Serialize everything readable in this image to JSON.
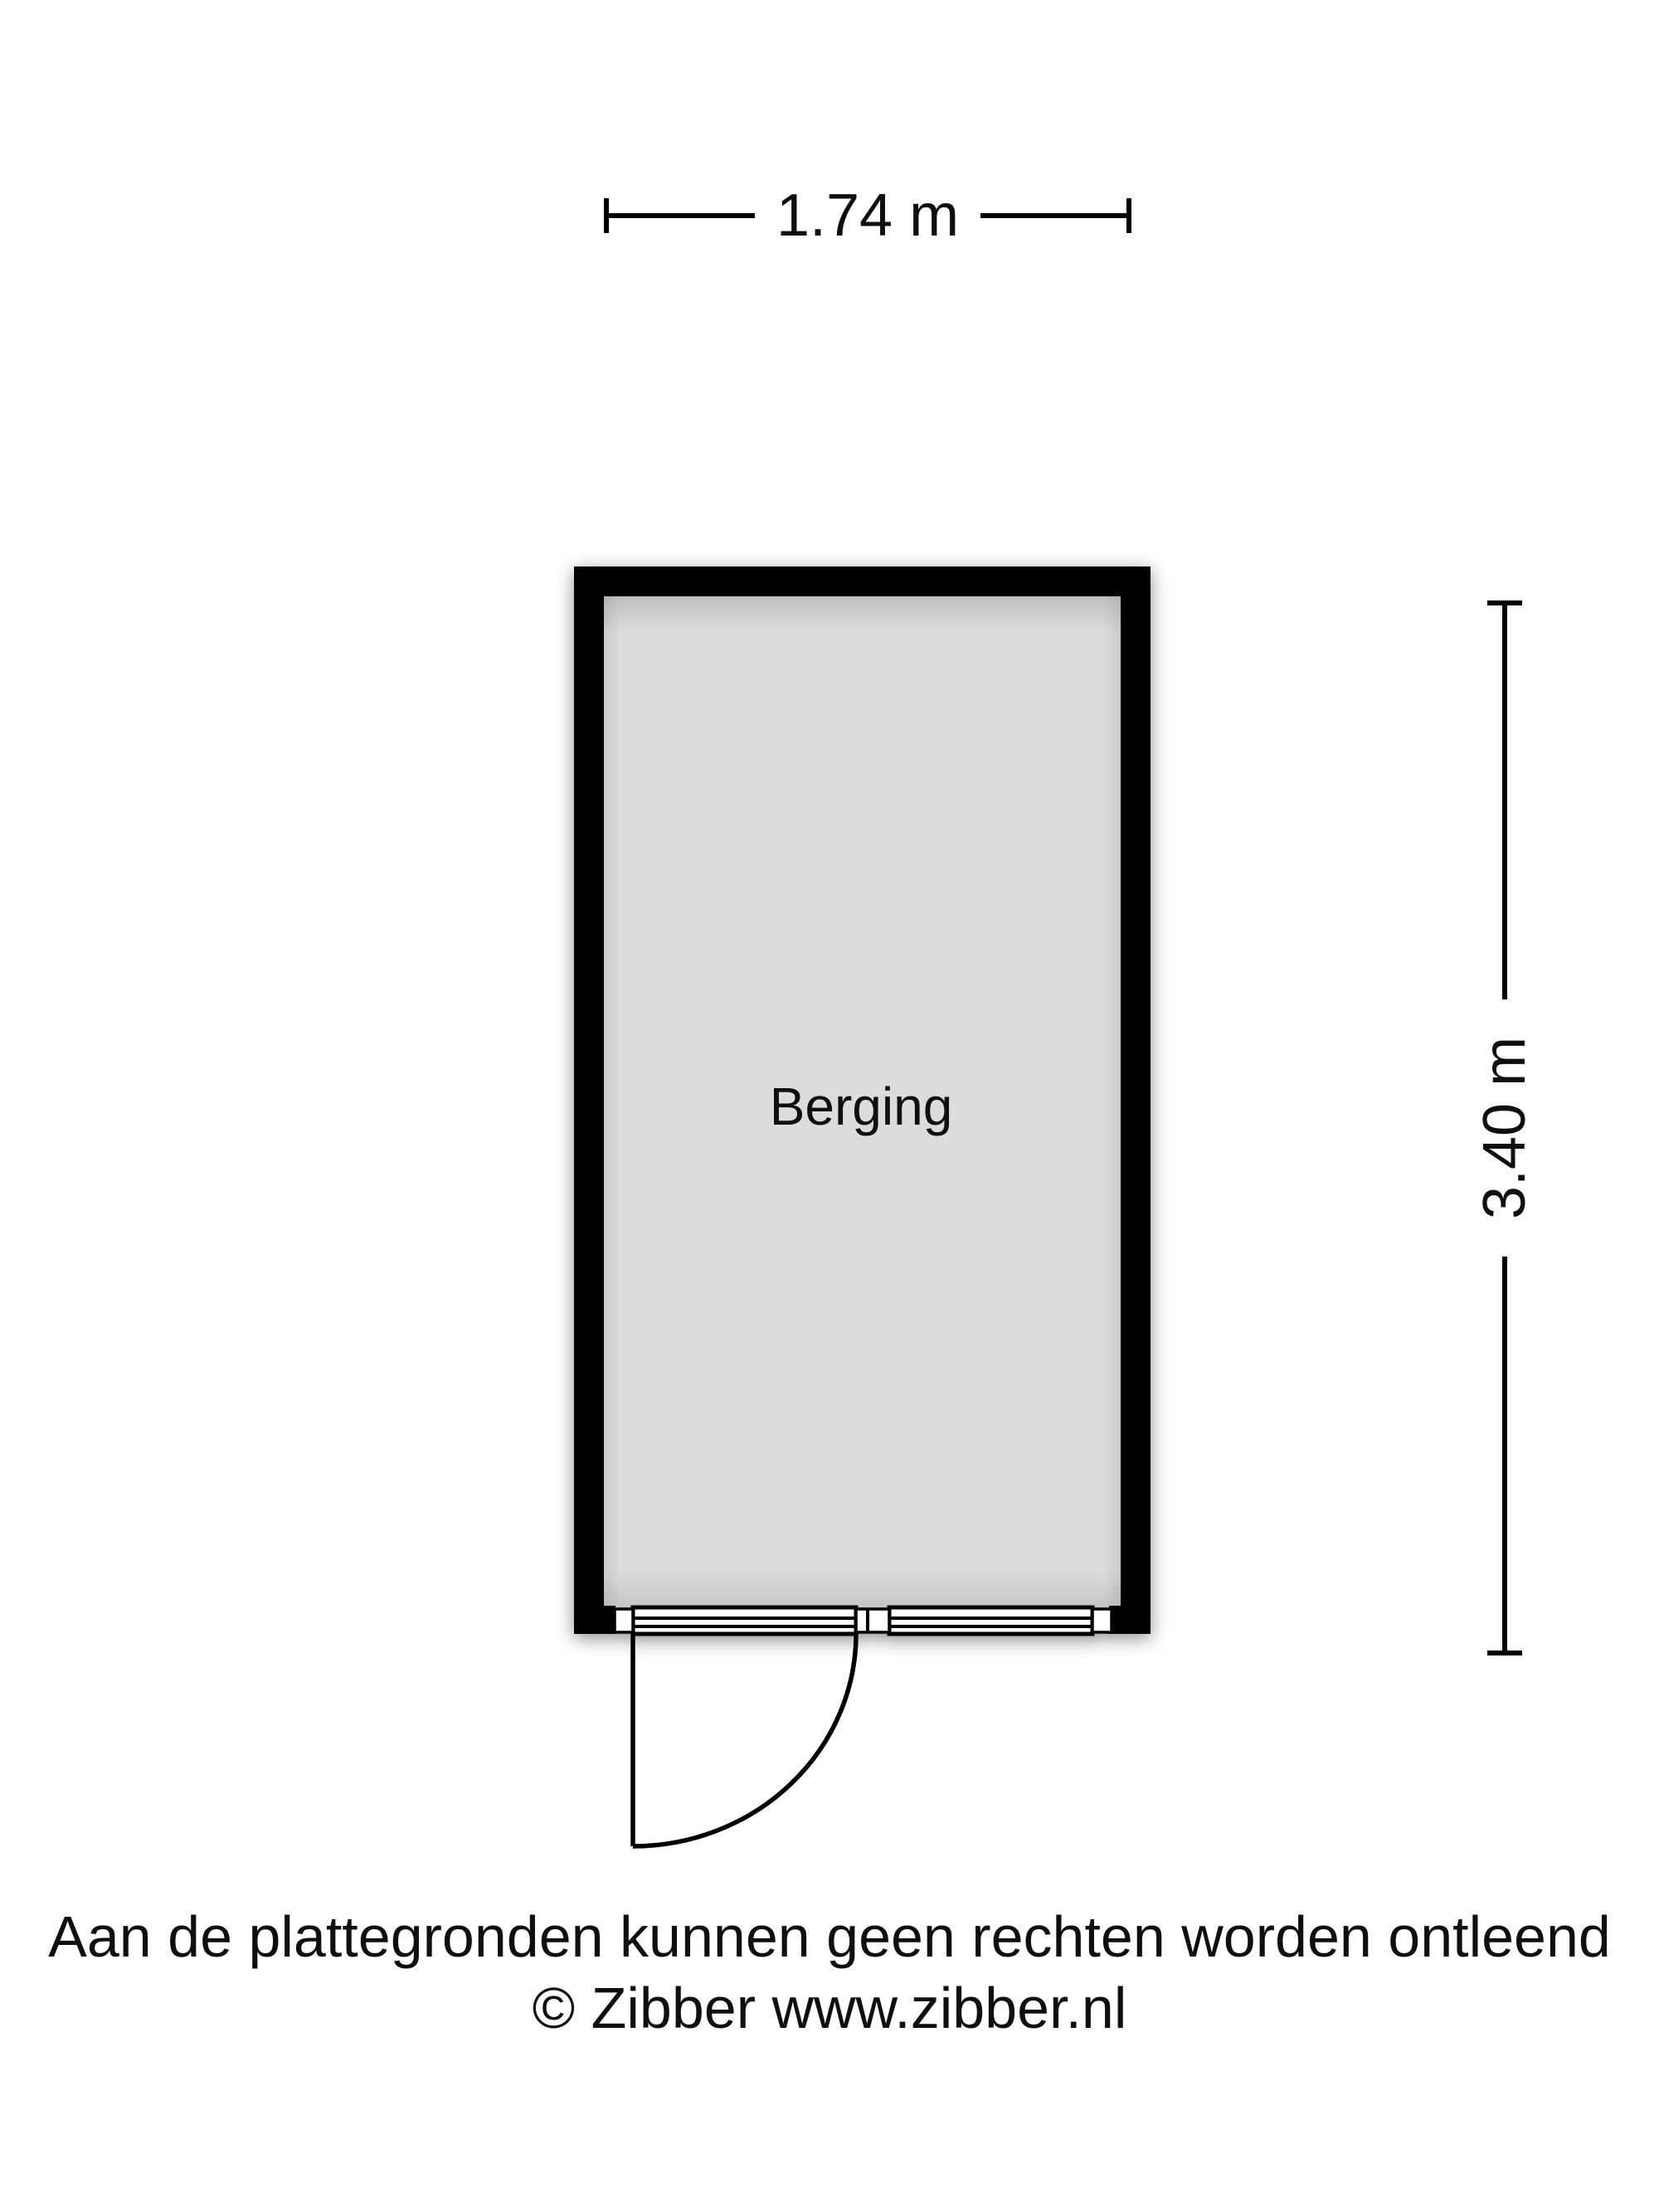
{
  "floorplan": {
    "room": {
      "label": "Berging"
    },
    "dimensions": {
      "width_label": "1.74 m",
      "height_label": "3.40 m"
    }
  },
  "footer": {
    "disclaimer": "Aan de plattegronden kunnen geen rechten worden ontleend",
    "copyright": "© Zibber www.zibber.nl"
  },
  "colors": {
    "wall": "#000000",
    "floor": "#dcdcdc",
    "line": "#000000",
    "text": "#0f0f0f"
  }
}
